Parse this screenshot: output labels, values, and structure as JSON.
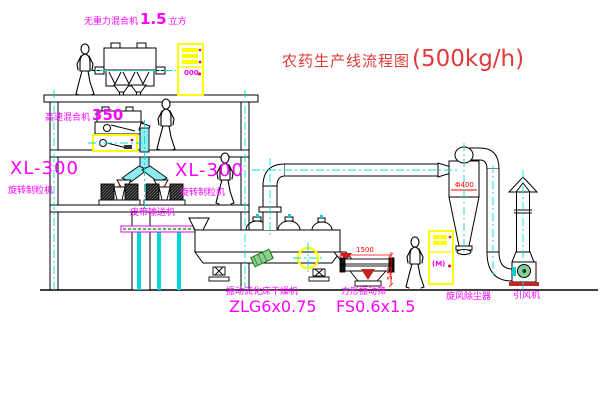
{
  "title": {
    "name": "农药生产线流程图",
    "capacity": "(500kg/h)"
  },
  "labels": {
    "gravity_mixer": {
      "name": "无重力混合机",
      "value": "1.5",
      "unit": "立方"
    },
    "high_speed_mixer": {
      "name": "高速混合机",
      "value": "350"
    },
    "granulator_left": {
      "model": "XL-300",
      "name": "旋转制粒机"
    },
    "granulator_right": {
      "model": "XL-300",
      "name": "旋转制粒机"
    },
    "belt_conveyor": {
      "name": "皮带输送机"
    },
    "dryer": {
      "name": "振动流化床干燥机",
      "model": "ZLG6x0.75"
    },
    "sieve": {
      "name": "方形振动筛",
      "model": "FS0.6x1.5"
    },
    "cyclone": {
      "name": "旋风除尘器"
    },
    "fan": {
      "name": "引风机"
    }
  },
  "dims": {
    "sieve_length": "1500",
    "sieve_height": "540",
    "cyclone_diameter": "Φ400"
  },
  "cabinets": {
    "upper": {
      "display": "000"
    },
    "lower": {
      "display": "(M)"
    }
  },
  "colors": {
    "label_magenta": "#FF00FF",
    "title_red": "#E03A3A",
    "dimension_red": "#FF0000",
    "centerline_cyan": "#00DCDC",
    "pipe_fill_cyan": "#8CEEF2",
    "cabinet_yellow": "#FFFF00",
    "motor_green": "#2E9E2E",
    "line_black": "#000000"
  }
}
